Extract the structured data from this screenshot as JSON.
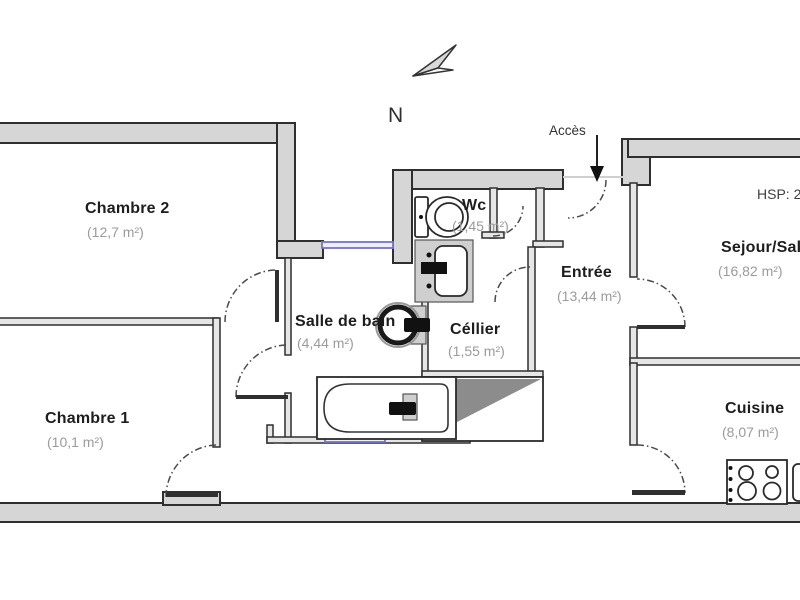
{
  "compass": {
    "label": "N"
  },
  "access": {
    "label": "Accès"
  },
  "ceiling_height": {
    "label": "HSP: 2,"
  },
  "rooms": [
    {
      "id": "chambre2",
      "name": "Chambre 2",
      "area": "(12,7 m²)"
    },
    {
      "id": "wc",
      "name": "Wc",
      "area": "(1,45 m²)"
    },
    {
      "id": "entree",
      "name": "Entrée",
      "area": "(13,44 m²)"
    },
    {
      "id": "sejour",
      "name": "Sejour/Salle",
      "area": "(16,82 m²)"
    },
    {
      "id": "salle-de-bain",
      "name": "Salle de bain",
      "area": "(4,44 m²)"
    },
    {
      "id": "cellier",
      "name": "Céllier",
      "area": "(1,55 m²)"
    },
    {
      "id": "chambre1",
      "name": "Chambre 1",
      "area": "(10,1 m²)"
    },
    {
      "id": "cuisine",
      "name": "Cuisine",
      "area": "(8,07 m²)"
    }
  ],
  "fixtures": [
    "toilet",
    "water-heater",
    "washbasin",
    "bathtub",
    "stove"
  ],
  "colors": {
    "wall_fill": "#d6d6d6",
    "wall_stroke": "#2f2f2f",
    "window_stroke": "#7575c5",
    "triangle_fill": "#8c8c8c",
    "label_color": "#1d1d1d",
    "area_color": "#9b9b9b"
  }
}
